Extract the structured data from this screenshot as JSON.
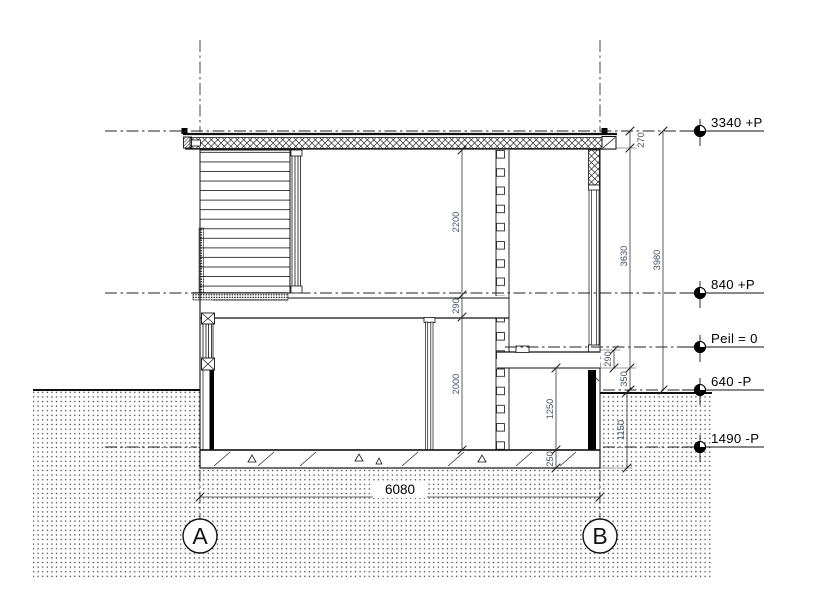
{
  "drawing_title": "Building cross section A-B",
  "levels": [
    {
      "label": "3340 +P"
    },
    {
      "label": "840 +P"
    },
    {
      "label": "Peil = 0"
    },
    {
      "label": "640 -P"
    },
    {
      "label": "1490 -P"
    }
  ],
  "grid_axes": [
    {
      "label": "A"
    },
    {
      "label": "B"
    }
  ],
  "dimensions": {
    "roof_thickness": "270",
    "right_zone_height": "3630",
    "right_total_height": "3980",
    "upper_room_height": "2200",
    "upper_floor_thickness": "290",
    "lower_room_height": "2000",
    "right_slab_thickness": "290",
    "slab_to_ground": "350",
    "pit_height": "1250",
    "bottom_slab_thickness": "250",
    "ground_to_foundation": "1150",
    "overall_width": "6080"
  }
}
